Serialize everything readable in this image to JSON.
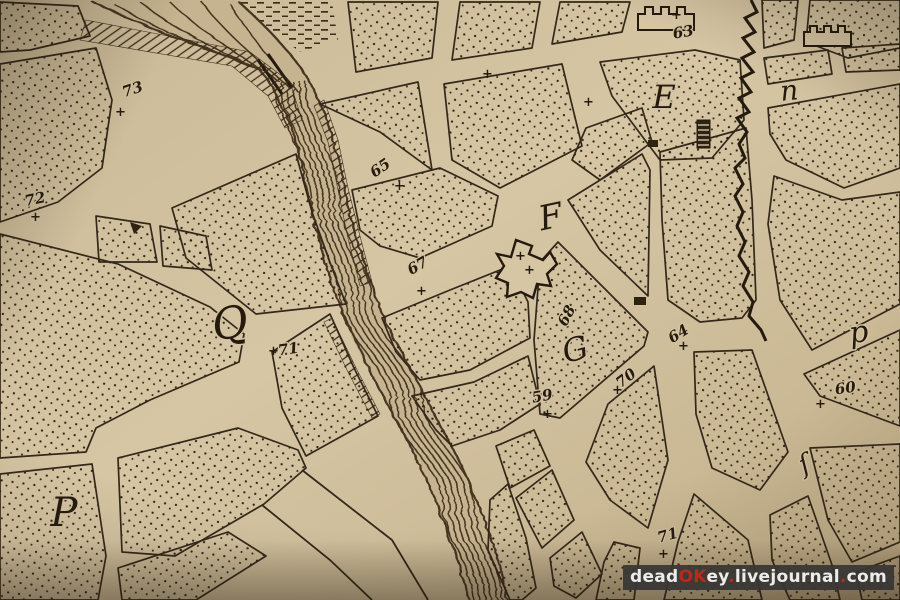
{
  "palette": {
    "paper": "#d3c3a1",
    "ink": "#2a2012",
    "river_base": "#c6b490",
    "watermark_bg": "#383634",
    "watermark_text": "#ececec",
    "watermark_accent": "#c3241c"
  },
  "map": {
    "cross_glyph": "+",
    "letters": [
      {
        "text": "Q"
      },
      {
        "text": "P"
      },
      {
        "text": "F"
      },
      {
        "text": "E"
      },
      {
        "text": "G"
      },
      {
        "text": "n"
      },
      {
        "text": "p"
      },
      {
        "text": "ſ"
      }
    ],
    "numbers": [
      {
        "text": "73"
      },
      {
        "text": "72"
      },
      {
        "text": "71"
      },
      {
        "text": "65"
      },
      {
        "text": "67"
      },
      {
        "text": "63"
      },
      {
        "text": "68"
      },
      {
        "text": "64"
      },
      {
        "text": "70"
      },
      {
        "text": "59"
      },
      {
        "text": "60"
      },
      {
        "text": "71"
      }
    ]
  },
  "watermark": {
    "segments": [
      {
        "text": "dead"
      },
      {
        "text": "OK"
      },
      {
        "text": "ey"
      },
      {
        "text": "."
      },
      {
        "text": "livejournal"
      },
      {
        "text": "."
      },
      {
        "text": "com"
      }
    ]
  }
}
